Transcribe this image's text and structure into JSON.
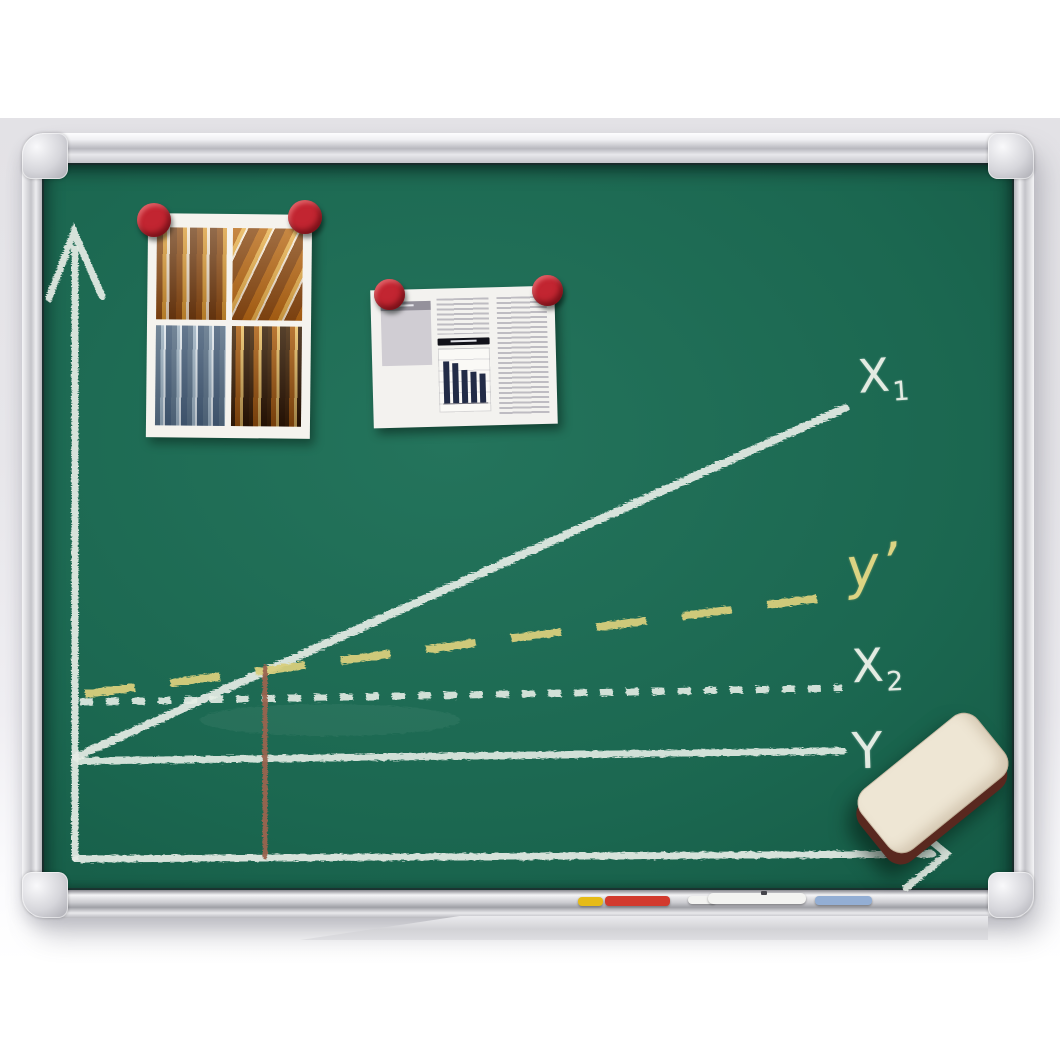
{
  "scene": {
    "subject": "green chalkboard with aluminium frame, chalk line graph, pinned photos, eraser and markers"
  },
  "board": {
    "colors": {
      "surface_green": "#1b6750",
      "frame_silver": "#d6d6db",
      "chalk_white": "#e6ede6",
      "chalk_yellow": "#d8cf7c",
      "marker_line_brown": "#9a6450"
    },
    "labels": {
      "x1": {
        "base": "X",
        "sub": "1"
      },
      "y_prime": {
        "text": "y’"
      },
      "x2": {
        "base": "X",
        "sub": "2"
      },
      "y": {
        "text": "Y"
      }
    }
  },
  "pinned": {
    "collage": {
      "magnet_color": "#c22531",
      "panel_names": [
        "amber-bottles-photo",
        "amber-tubes-photo",
        "blue-lab-glass-photo",
        "amber-vials-photo"
      ]
    },
    "document": {
      "magnet_color": "#c22531",
      "chart": {
        "type": "bar",
        "values": [
          100,
          95,
          78,
          74,
          70
        ],
        "bar_color": "#222b46"
      }
    }
  },
  "tray": {
    "markers": [
      {
        "name": "yellow-marker",
        "color": "#e6bb17"
      },
      {
        "name": "red-marker",
        "color": "#d23a2e"
      },
      {
        "name": "white-marker",
        "color": "#f3f3f1"
      },
      {
        "name": "blue-marker",
        "color": "#93aed4"
      }
    ]
  },
  "eraser": {
    "face_color": "#eee6d4",
    "side_color": "#59281f"
  },
  "chart_data": {
    "type": "line",
    "title": "hand-drawn chalk graph on blackboard",
    "axes": {
      "x_label": "",
      "y_label": "",
      "arrows": true,
      "grid": false
    },
    "series": [
      {
        "name": "X₁",
        "style": "solid",
        "color": "#e6ede6",
        "points_rel": [
          [
            0.0,
            0.14
          ],
          [
            1.0,
            0.64
          ]
        ]
      },
      {
        "name": "y’",
        "style": "dashed",
        "color": "#d8cf7c",
        "points_rel": [
          [
            0.0,
            0.23
          ],
          [
            1.0,
            0.37
          ]
        ]
      },
      {
        "name": "X₂",
        "style": "dotted",
        "color": "#e6ede6",
        "points_rel": [
          [
            0.0,
            0.22
          ],
          [
            1.0,
            0.24
          ]
        ]
      },
      {
        "name": "Y",
        "style": "solid",
        "color": "#e6ede6",
        "points_rel": [
          [
            0.0,
            0.14
          ],
          [
            1.0,
            0.15
          ]
        ]
      }
    ],
    "annotations": [
      {
        "name": "vertical-marker-line",
        "color": "#9a6450",
        "x_rel": 0.245,
        "from": "x-axis",
        "to": "line X₁"
      }
    ],
    "legend": "labels written at right end of each line"
  }
}
